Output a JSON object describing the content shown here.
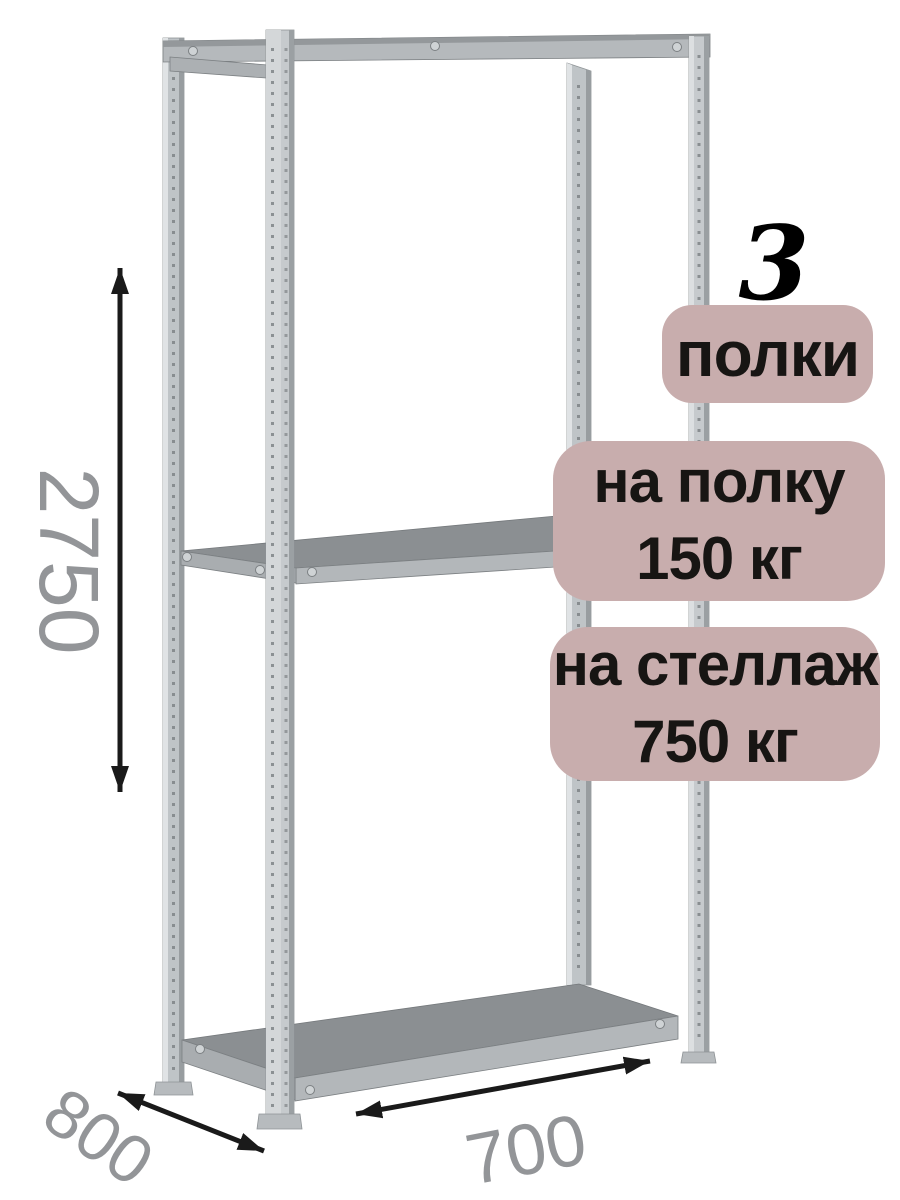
{
  "page": {
    "background_color": "#ffffff",
    "description": "Product image of a 3-shelf metal shelving rack with load-capacity badges and overall dimensions"
  },
  "badges": {
    "shelf_count": "3",
    "shelf_count_label": "полки",
    "per_shelf_line1": "на полку",
    "per_shelf_line2": "150 кг",
    "per_rack_line1": "на стеллаж",
    "per_rack_line2": "750 кг",
    "bg_color": "#c8adad",
    "text_color": "#171513"
  },
  "dimensions": {
    "height": "2750",
    "depth": "800",
    "width": "700",
    "unit": "mm (implied)",
    "label_color": "#939598",
    "arrow_color": "#1a1a1a"
  },
  "illustration": {
    "subject": "metal-shelving-rack",
    "shelves": 3,
    "posts": 4,
    "metal_color": "#c3c7ca",
    "shelf_top_color": "#8b8f92",
    "shelf_edge_color": "#b3b7ba"
  }
}
